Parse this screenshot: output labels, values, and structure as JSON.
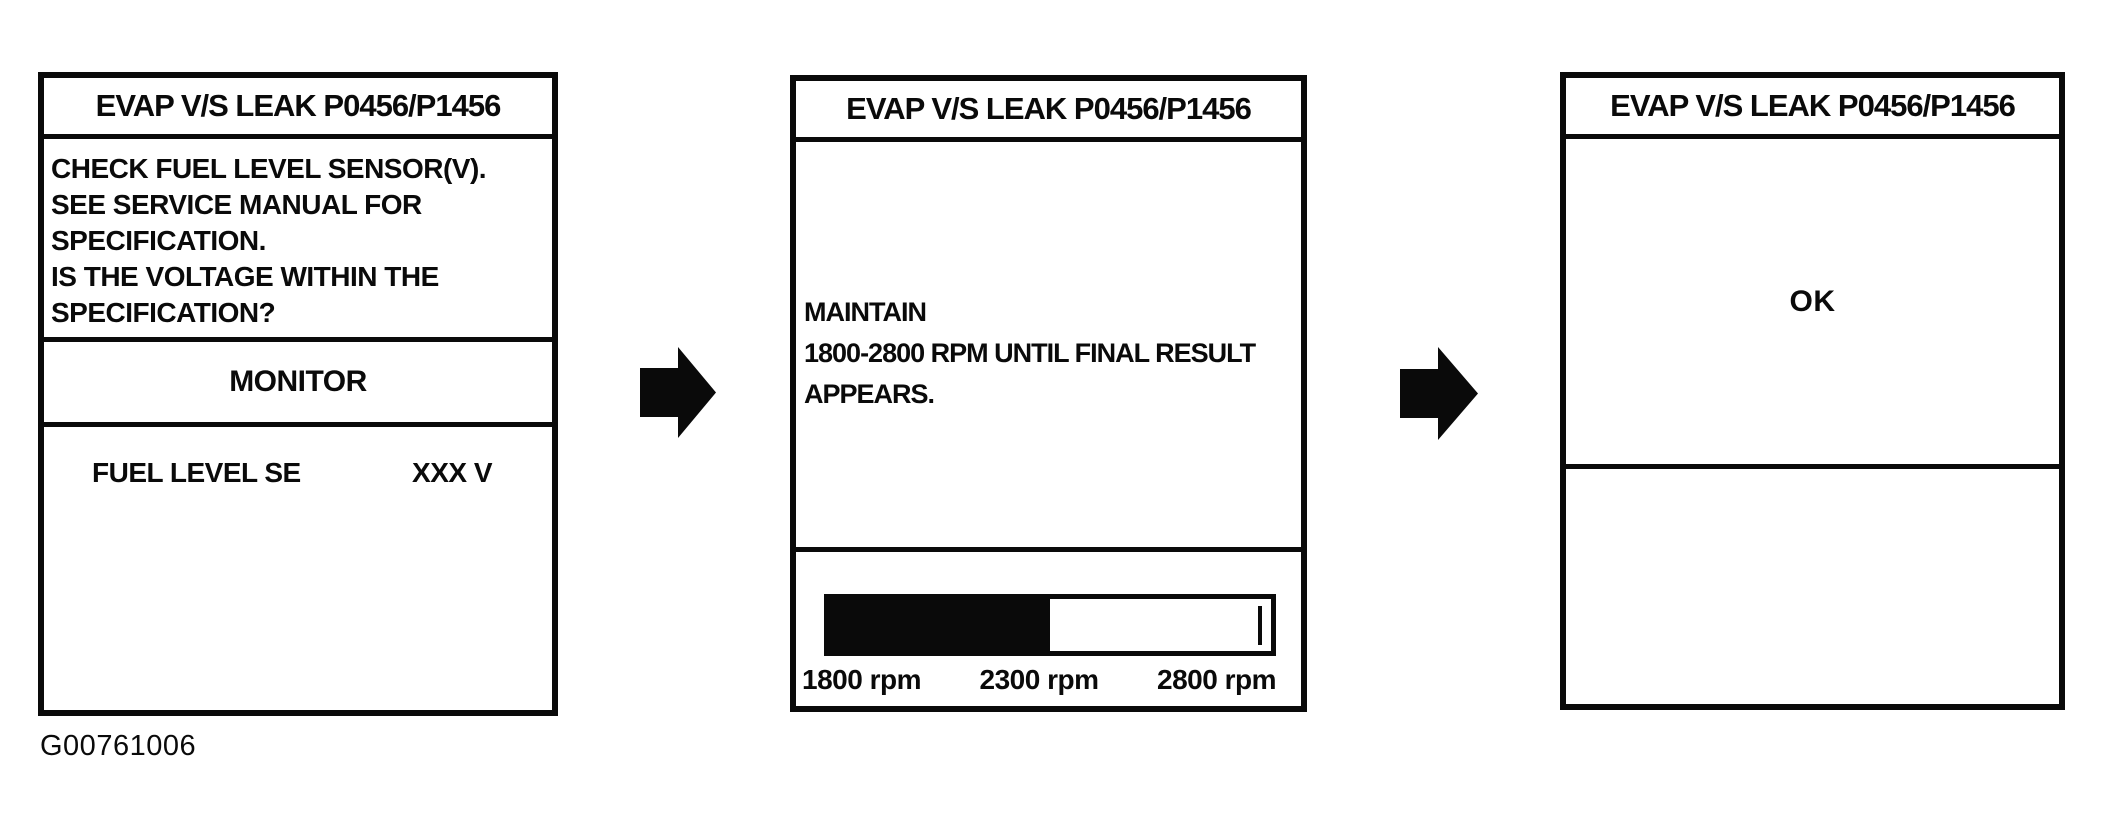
{
  "caption": "G00761006",
  "colors": {
    "ink": "#0a0a0a",
    "paper": "#ffffff"
  },
  "screens": [
    {
      "title": "EVAP V/S LEAK P0456/P1456",
      "instructions": [
        "CHECK FUEL LEVEL SENSOR(V).",
        "SEE SERVICE MANUAL FOR",
        "SPECIFICATION.",
        "IS THE VOLTAGE WITHIN THE",
        "SPECIFICATION?"
      ],
      "monitor_label": "MONITOR",
      "monitor_item": {
        "name": "FUEL LEVEL SE",
        "value": "XXX V"
      }
    },
    {
      "title": "EVAP V/S LEAK P0456/P1456",
      "instructions": [
        "MAINTAIN",
        "1800-2800 RPM UNTIL FINAL RESULT",
        "APPEARS."
      ],
      "gauge": {
        "scale_labels": [
          "1800 rpm",
          "2300 rpm",
          "2800 rpm"
        ],
        "fill_percent": 50,
        "marker_percent": 97
      }
    },
    {
      "title": "EVAP V/S LEAK P0456/P1456",
      "result": "OK"
    }
  ]
}
